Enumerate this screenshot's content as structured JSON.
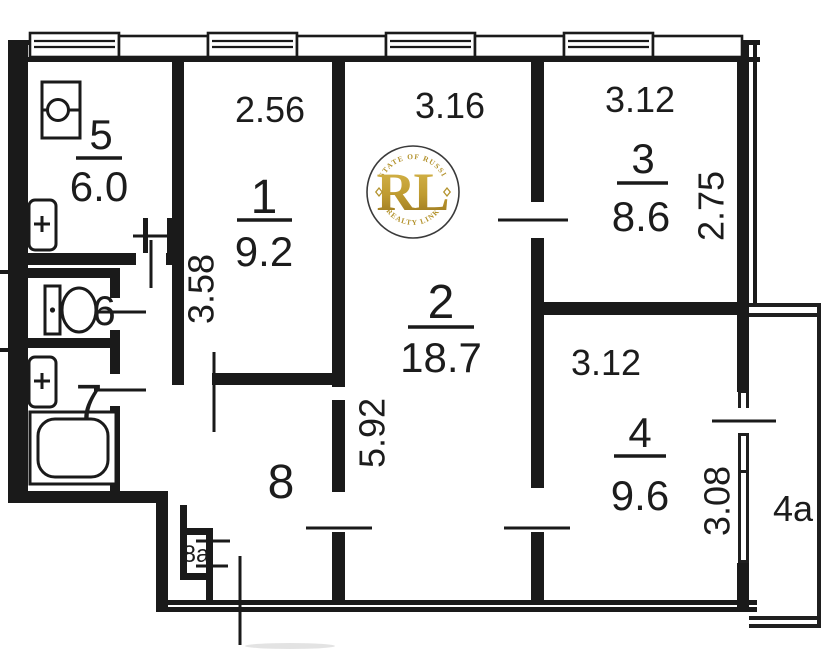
{
  "plan": {
    "rooms": {
      "r1": {
        "number": "1",
        "area": "9.2",
        "width_dim": "2.56",
        "depth_dim": "3.58"
      },
      "r2": {
        "number": "2",
        "area": "18.7",
        "width_dim": "3.16",
        "depth_dim": "5.92"
      },
      "r3": {
        "number": "3",
        "area": "8.6",
        "width_dim": "3.12",
        "depth_dim": "2.75"
      },
      "r4": {
        "number": "4",
        "area": "9.6",
        "width_dim": "3.12",
        "depth_dim": "3.08"
      },
      "r5": {
        "number": "5",
        "area": "6.0"
      },
      "r6": {
        "number": "6"
      },
      "r7": {
        "number": "7"
      },
      "r8": {
        "number": "8"
      },
      "r8a": {
        "number": "8a"
      },
      "r4a": {
        "number": "4a"
      }
    },
    "fixtures": [
      "kitchen-sink",
      "washbasin",
      "toilet",
      "washbasin",
      "bathtub"
    ],
    "line_color": "#1a1a1a"
  },
  "watermark": {
    "monogram": "RL",
    "arc_top": "ESTATE OF RUSSIA",
    "arc_bottom": "REALTY LINK",
    "gold": "#b3922c"
  }
}
